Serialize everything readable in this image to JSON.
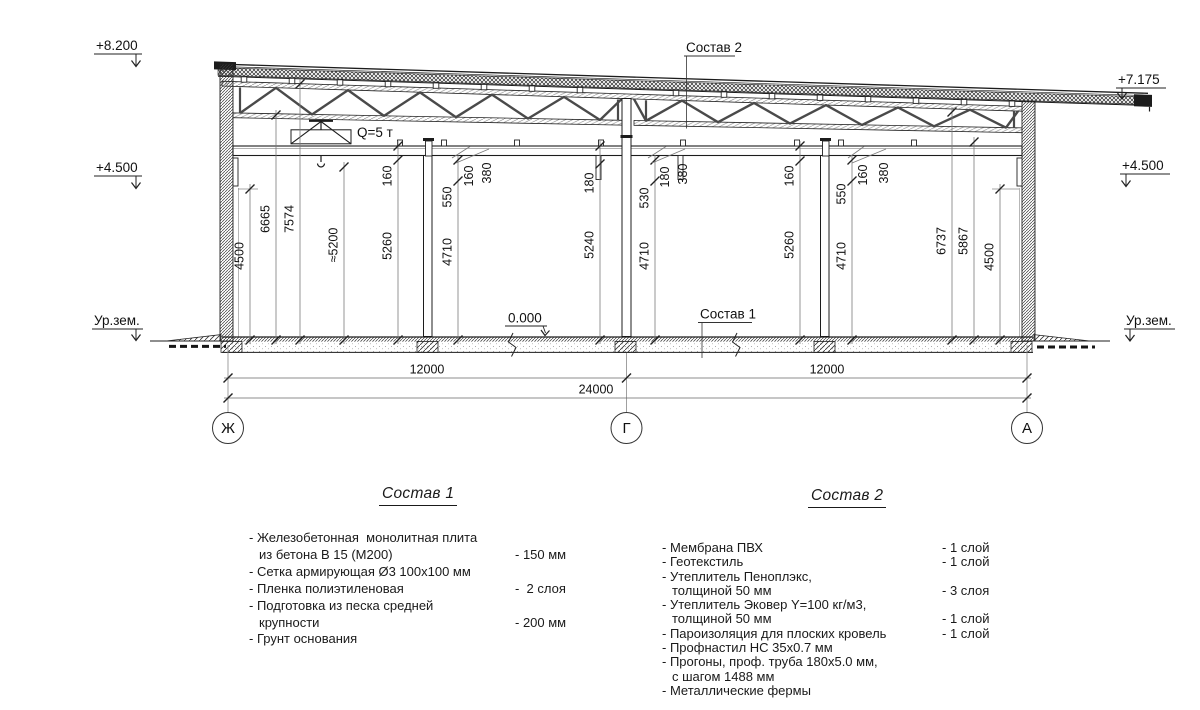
{
  "drawing": {
    "elevations": {
      "top_left": "+8.200",
      "mid_left": "+4.500",
      "ground_left": "Ур.зем.",
      "top_right": "+7.175",
      "mid_right": "+4.500",
      "ground_right": "Ур.зем."
    },
    "callouts": {
      "sostav2": "Состав 2",
      "sostav1": "Состав 1",
      "zero": "0.000",
      "crane": "Q=5 т"
    },
    "axes": {
      "left": "Ж",
      "middle": "Г",
      "right": "А"
    },
    "h_dims": {
      "left_span": "12000",
      "right_span": "12000",
      "total": "24000"
    },
    "v_dims": {
      "d1": "4500",
      "d2": "6665",
      "d3": "7574",
      "d4": "≈5200",
      "d5a": "160",
      "d5b": "5260",
      "d6a": "550",
      "d6b": "4710",
      "l1": "160",
      "l2": "380",
      "d7a": "180",
      "d7b": "5240",
      "d8a": "530",
      "d8b": "4710",
      "l3": "180",
      "l4": "380",
      "d9a": "160",
      "d9b": "5260",
      "d10a": "550",
      "d10b": "4710",
      "l5": "160",
      "l6": "380",
      "d11": "6737",
      "d12": "5867",
      "d13": "4500"
    }
  },
  "sostav1": {
    "title": "Состав 1",
    "rows": [
      {
        "t": "- Железобетонная  монолитная плита",
        "v": ""
      },
      {
        "t": "из бетона В 15 (М200)",
        "v": "- 150 мм"
      },
      {
        "t": "- Сетка армирующая Ø3 100х100 мм",
        "v": ""
      },
      {
        "t": "- Пленка полиэтиленовая",
        "v": "-  2 слоя"
      },
      {
        "t": "- Подготовка из песка средней",
        "v": ""
      },
      {
        "t": "крупности",
        "v": "- 200 мм"
      },
      {
        "t": "- Грунт основания",
        "v": ""
      }
    ]
  },
  "sostav2": {
    "title": "Состав 2",
    "rows": [
      {
        "t": "- Мембрана ПВХ",
        "v": "- 1 слой"
      },
      {
        "t": "- Геотекстиль",
        "v": "- 1 слой"
      },
      {
        "t": "- Утеплитель Пеноплэкс,",
        "v": ""
      },
      {
        "t": "толщиной 50 мм",
        "v": "- 3 слоя"
      },
      {
        "t": "- Утеплитель Эковер Y=100 кг/м3,",
        "v": ""
      },
      {
        "t": "толщиной 50 мм",
        "v": "- 1 слой"
      },
      {
        "t": "- Пароизоляция для плоских кровель",
        "v": "- 1 слой"
      },
      {
        "t": "- Профнастил НС 35х0.7 мм",
        "v": ""
      },
      {
        "t": "- Прогоны, проф. труба 180х5.0 мм,",
        "v": ""
      },
      {
        "t": "с шагом 1488 мм",
        "v": ""
      },
      {
        "t": "- Металлические фермы",
        "v": ""
      }
    ]
  }
}
